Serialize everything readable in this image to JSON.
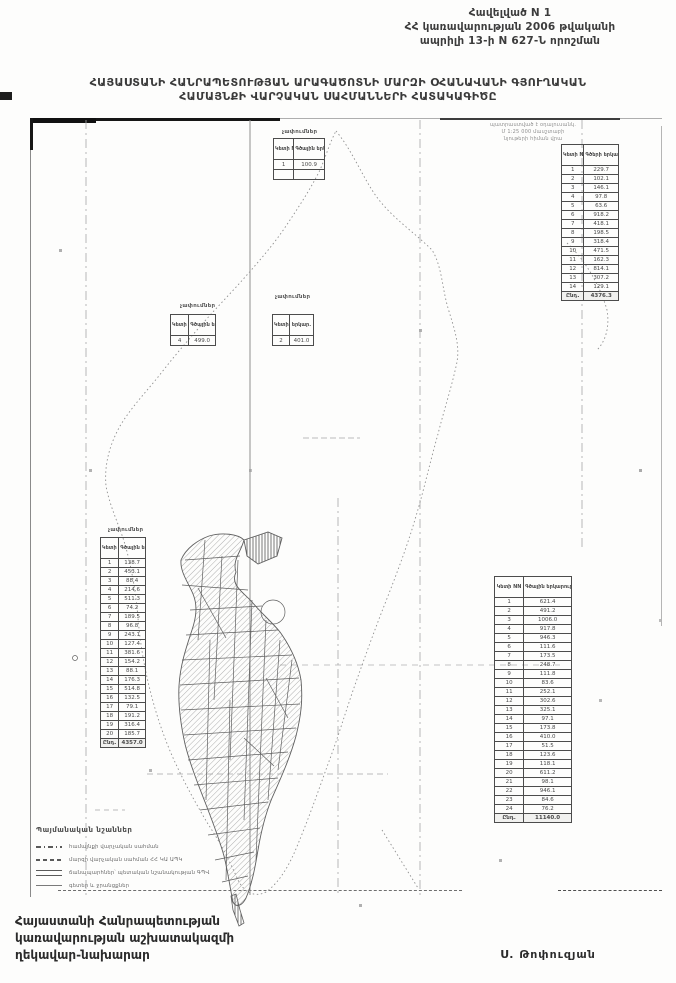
{
  "page": {
    "appendix": [
      "Հավելված N 1",
      "ՀՀ կառավարության 2006 թվականի",
      "ապրիլի 13-ի N 627-Ն որոշման"
    ],
    "title": [
      "ՀԱՅԱՍՏԱՆԻ ՀԱՆՐԱՊԵՏՈՒԹՅԱՆ ԱՐԱԳԱԾՈՏՆԻ ՄԱՐԶԻ ՕՀԱՆԱՎԱՆԻ ԳՅՈՒՂԱԿԱՆ",
      "ՀԱՄԱՅՆՔԻ ՎԱՐՉԱԿԱՆ ՍԱՀՄԱՆՆԵՐԻ ՀԱՏԱԿԱԳԻԾԸ"
    ],
    "footer_left": [
      "Հայաստանի Հանրապետության",
      "կառավարության աշխատակազմի",
      "ղեկավար-նախարար"
    ],
    "signature": "Ս. Թոփուզյան"
  },
  "map": {
    "stamp_note": [
      "պատրաստված է օդալուսանկ.",
      "Մ 1:25 000 մասշտաբի",
      "նյութերի հիման վրա"
    ],
    "tableA": {
      "label": "չափումներ",
      "header": [
        "Կետի NN",
        "Գծային երկար."
      ],
      "rows": [
        [
          "1",
          "100.9"
        ],
        [
          "",
          ""
        ]
      ]
    },
    "tableB": {
      "label": "",
      "header": [
        "Կետի NN",
        "Գծերի երկարութ. (մ)"
      ],
      "rows": [
        [
          "1",
          "229.7"
        ],
        [
          "2",
          "102.1"
        ],
        [
          "3",
          "146.1"
        ],
        [
          "4",
          "97.8"
        ],
        [
          "5",
          "63.6"
        ],
        [
          "6",
          "918.2"
        ],
        [
          "7",
          "418.1"
        ],
        [
          "8",
          "198.5"
        ],
        [
          "9",
          "318.4"
        ],
        [
          "10",
          "471.5"
        ],
        [
          "11",
          "162.3"
        ],
        [
          "12",
          "814.1"
        ],
        [
          "13",
          "307.2"
        ],
        [
          "14",
          "129.1"
        ]
      ],
      "total": [
        "Ընդ.",
        "4376.3"
      ]
    },
    "tableC": {
      "label": "չափումներ",
      "header": [
        "Կետի NN",
        "Գծային երկար."
      ],
      "rows": [
        [
          "4",
          "499.0"
        ]
      ]
    },
    "tableD": {
      "label": "չափումներ",
      "header": [
        "Կետի N",
        "երկար."
      ],
      "rows": [
        [
          "2",
          "401.0"
        ]
      ]
    },
    "tableE": {
      "label": "չափումներ",
      "header": [
        "Կետի NN",
        "Գծային երկար. (մ)"
      ],
      "rows": [
        [
          "1",
          "138.7"
        ],
        [
          "2",
          "453.1"
        ],
        [
          "3",
          "88.4"
        ],
        [
          "4",
          "214.6"
        ],
        [
          "5",
          "511.3"
        ],
        [
          "6",
          "74.2"
        ],
        [
          "7",
          "189.5"
        ],
        [
          "8",
          "96.8"
        ],
        [
          "9",
          "243.1"
        ],
        [
          "10",
          "127.4"
        ],
        [
          "11",
          "381.6"
        ],
        [
          "12",
          "154.2"
        ],
        [
          "13",
          "88.1"
        ],
        [
          "14",
          "176.3"
        ],
        [
          "15",
          "514.8"
        ],
        [
          "16",
          "132.5"
        ],
        [
          "17",
          "79.1"
        ],
        [
          "18",
          "191.2"
        ],
        [
          "19",
          "316.4"
        ],
        [
          "20",
          "185.7"
        ]
      ],
      "total": [
        "Ընդ.",
        "4357.0"
      ]
    },
    "tableF": {
      "label": "",
      "header": [
        "Կետի NN",
        "Գծային երկարութ. (մետր)"
      ],
      "rows": [
        [
          "1",
          "621.4"
        ],
        [
          "2",
          "491.2"
        ],
        [
          "3",
          "1006.0"
        ],
        [
          "4",
          "917.8"
        ],
        [
          "5",
          "946.3"
        ],
        [
          "6",
          "111.6"
        ],
        [
          "7",
          "173.5"
        ],
        [
          "8",
          "248.7"
        ],
        [
          "9",
          "111.8"
        ],
        [
          "10",
          "83.6"
        ],
        [
          "11",
          "252.1"
        ],
        [
          "12",
          "302.6"
        ],
        [
          "13",
          "325.1"
        ],
        [
          "14",
          "97.1"
        ],
        [
          "15",
          "173.8"
        ],
        [
          "16",
          "410.0"
        ],
        [
          "17",
          "51.5"
        ],
        [
          "18",
          "123.6"
        ],
        [
          "19",
          "118.1"
        ],
        [
          "20",
          "611.2"
        ],
        [
          "21",
          "98.1"
        ],
        [
          "22",
          "946.1"
        ],
        [
          "23",
          "84.6"
        ],
        [
          "24",
          "76.2"
        ]
      ],
      "total": [
        "Ընդ.",
        "11140.0"
      ]
    }
  },
  "legend": {
    "title": "Պայմանական նշաններ",
    "items": [
      "համայնքի վարչական սահման",
      "մարզի վարչական սահման ՀՀ ԿԱ ԱՊԿ",
      "ճանապարհներ՝ պետական նշանակության ԳՊՎ",
      "գետեր և ջրանցքներ"
    ]
  },
  "colors": {
    "ink": "#3a3a3a",
    "faint_line": "#9a9a9a",
    "parcel_line": "#5f5f5f"
  }
}
